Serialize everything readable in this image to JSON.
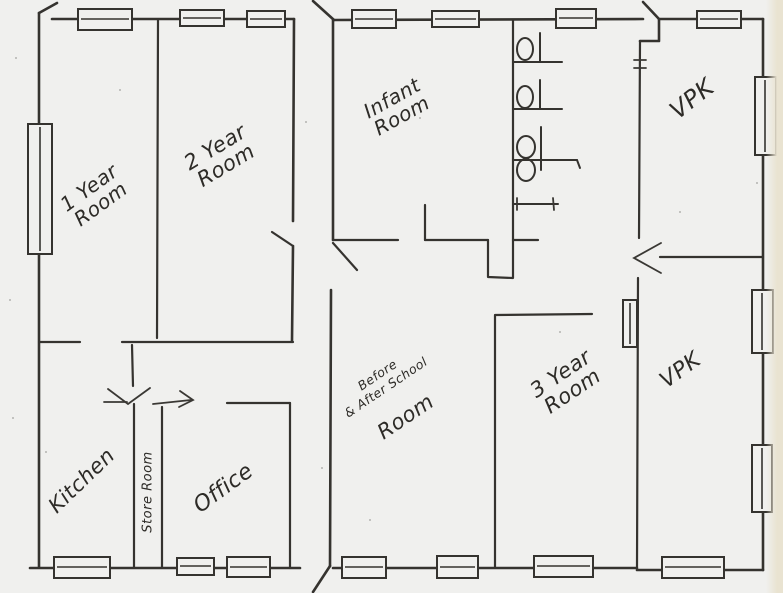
{
  "plan": {
    "kind": "hand-drawn floor plan",
    "colors": {
      "paper": "#f0f0ee",
      "ink": "#35332f",
      "page_edge": "#e9e3d1"
    },
    "fixtures": {
      "toilets": 3,
      "toilet_stalls": 4,
      "windows": 19
    }
  },
  "rooms": [
    {
      "id": "one-year-room",
      "label": "1 Year\nRoom"
    },
    {
      "id": "two-year-room",
      "label": "2 Year\nRoom"
    },
    {
      "id": "infant-room",
      "label": "Infant\nRoom"
    },
    {
      "id": "vpk-north",
      "label": "VPK"
    },
    {
      "id": "kitchen",
      "label": "Kitchen"
    },
    {
      "id": "store-room",
      "label": "Store Room"
    },
    {
      "id": "office",
      "label": "Office"
    },
    {
      "id": "before-after-school-room",
      "label": "Before\n& After School",
      "label2": "Room"
    },
    {
      "id": "three-year-room",
      "label": "3 Year\nRoom"
    },
    {
      "id": "vpk-south",
      "label": "VPK"
    }
  ]
}
